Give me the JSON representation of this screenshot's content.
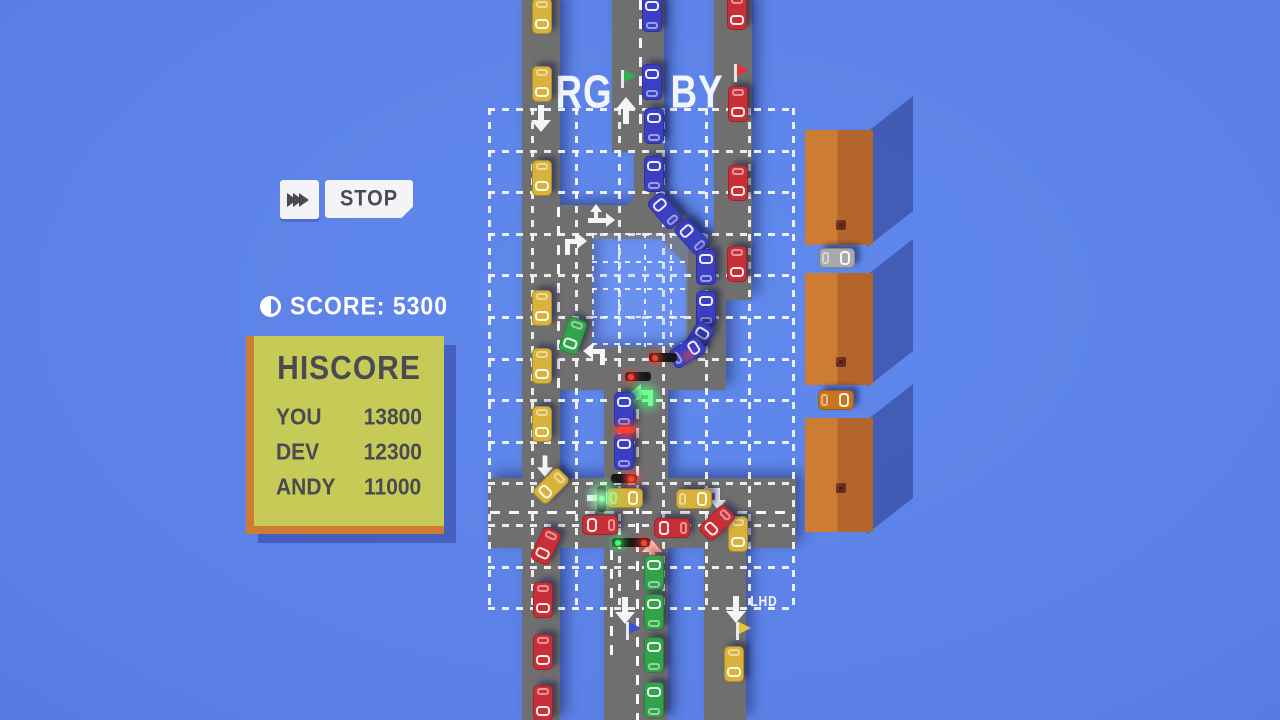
{
  "hud": {
    "stop_label": "STOP",
    "score_label": "SCORE:",
    "score_value": "5300",
    "hiscore": {
      "title": "HISCORE",
      "rows": [
        {
          "name": "YOU",
          "score": "13800"
        },
        {
          "name": "DEV",
          "score": "12300"
        },
        {
          "name": "ANDY",
          "score": "11000"
        }
      ]
    }
  },
  "palette": {
    "road": "#6F6F6F",
    "yellow": "#D8B23A",
    "blue": "#3B3FC4",
    "red": "#C92F36",
    "green": "#31A44A",
    "gray": "#A7A9AC",
    "orange": "#C8741F",
    "panel": "#C6CB57",
    "panel_edge": "#CE7B33",
    "hud_text": "#4A4A52"
  },
  "scene": {
    "labels": [
      {
        "t": "RG",
        "x": 584,
        "y": 93,
        "s": 40
      },
      {
        "t": "BY",
        "x": 697,
        "y": 93,
        "s": 40
      },
      {
        "t": "LHD",
        "x": 764,
        "y": 601,
        "s": 13
      }
    ],
    "grid": {
      "x": 488,
      "y": 108,
      "w": 304,
      "h": 502,
      "nx": 8,
      "sx": 43.4,
      "ny": 13,
      "sy": 41.6
    },
    "block": {
      "x": 592,
      "y": 233,
      "w": 96,
      "h": 114,
      "nx": 4,
      "sx": 26,
      "ny": 5,
      "sy": 27.5
    },
    "roads": [
      {
        "x": 522,
        "y": 0,
        "w": 38,
        "h": 720
      },
      {
        "x": 612,
        "y": 0,
        "w": 52,
        "h": 152
      },
      {
        "x": 634,
        "y": 150,
        "w": 30,
        "h": 60
      },
      {
        "x": 556,
        "y": 205,
        "w": 118,
        "h": 34
      },
      {
        "x": 655,
        "y": 180,
        "w": 34,
        "h": 94,
        "rot": -45
      },
      {
        "x": 714,
        "y": 0,
        "w": 38,
        "h": 300
      },
      {
        "x": 686,
        "y": 240,
        "w": 64,
        "h": 60
      },
      {
        "x": 686,
        "y": 235,
        "w": 40,
        "h": 155
      },
      {
        "x": 556,
        "y": 205,
        "w": 36,
        "h": 185
      },
      {
        "x": 522,
        "y": 347,
        "w": 204,
        "h": 43
      },
      {
        "x": 604,
        "y": 347,
        "w": 64,
        "h": 373
      },
      {
        "x": 488,
        "y": 478,
        "w": 308,
        "h": 70
      },
      {
        "x": 704,
        "y": 478,
        "w": 42,
        "h": 242
      }
    ],
    "lanes": [
      {
        "x": 639,
        "y": 0,
        "len": 150,
        "v": true
      },
      {
        "x": 636,
        "y": 390,
        "len": 330,
        "v": true
      },
      {
        "x": 557,
        "y": 207,
        "len": 181,
        "v": true
      },
      {
        "x": 610,
        "y": 550,
        "len": 110,
        "v": true
      },
      {
        "x": 490,
        "y": 511,
        "len": 304,
        "v": false
      }
    ],
    "arrows": [
      {
        "x": 541,
        "y": 117,
        "rot": 180,
        "t": "str"
      },
      {
        "x": 626,
        "y": 112,
        "rot": 0,
        "t": "str"
      },
      {
        "x": 599,
        "y": 220,
        "rot": 0,
        "t": "fork"
      },
      {
        "x": 574,
        "y": 246,
        "rot": 0,
        "t": "upRight"
      },
      {
        "x": 596,
        "y": 356,
        "rot": 0,
        "t": "upLeft"
      },
      {
        "x": 545,
        "y": 465,
        "rot": 180,
        "t": "str",
        "scale": 0.8
      },
      {
        "x": 599,
        "y": 498,
        "rot": 90,
        "t": "str"
      },
      {
        "x": 713,
        "y": 497,
        "rot": 90,
        "t": "upRight"
      },
      {
        "x": 652,
        "y": 555,
        "rot": 0,
        "t": "str"
      },
      {
        "x": 625,
        "y": 609,
        "rot": 180,
        "t": "str"
      },
      {
        "x": 736,
        "y": 608,
        "rot": 180,
        "t": "str"
      },
      {
        "x": 644,
        "y": 397,
        "rot": 0,
        "t": "upLeft",
        "c": "#8CFFA8",
        "glow": true,
        "active": true
      }
    ],
    "buildings": [
      {
        "x": 805,
        "y": 130,
        "w": 68,
        "h": 115,
        "cy": 0.78
      },
      {
        "x": 805,
        "y": 273,
        "w": 68,
        "h": 112,
        "cy": 0.75
      },
      {
        "x": 805,
        "y": 418,
        "w": 68,
        "h": 114,
        "cy": 0.57
      }
    ],
    "cars": [
      {
        "x": 542,
        "y": 16,
        "r": 180,
        "c": "yellow"
      },
      {
        "x": 542,
        "y": 84,
        "r": 180,
        "c": "yellow"
      },
      {
        "x": 542,
        "y": 178,
        "r": 180,
        "c": "yellow"
      },
      {
        "x": 542,
        "y": 308,
        "r": 180,
        "c": "yellow"
      },
      {
        "x": 542,
        "y": 366,
        "r": 180,
        "c": "yellow"
      },
      {
        "x": 542,
        "y": 424,
        "r": 180,
        "c": "yellow"
      },
      {
        "x": 551,
        "y": 486,
        "r": 225,
        "c": "yellow"
      },
      {
        "x": 625,
        "y": 498,
        "r": 90,
        "c": "yellow"
      },
      {
        "x": 694,
        "y": 499,
        "r": 90,
        "c": "yellow"
      },
      {
        "x": 738,
        "y": 534,
        "r": 180,
        "c": "yellow"
      },
      {
        "x": 734,
        "y": 664,
        "r": 180,
        "c": "yellow"
      },
      {
        "x": 652,
        "y": 14,
        "r": 0,
        "c": "blue"
      },
      {
        "x": 652,
        "y": 82,
        "r": 0,
        "c": "blue"
      },
      {
        "x": 654,
        "y": 126,
        "r": 0,
        "c": "blue"
      },
      {
        "x": 654,
        "y": 174,
        "r": 0,
        "c": "blue"
      },
      {
        "x": 665,
        "y": 211,
        "r": -40,
        "c": "blue"
      },
      {
        "x": 692,
        "y": 237,
        "r": -42,
        "c": "blue"
      },
      {
        "x": 706,
        "y": 267,
        "r": 0,
        "c": "blue"
      },
      {
        "x": 706,
        "y": 309,
        "r": 0,
        "c": "blue"
      },
      {
        "x": 698,
        "y": 340,
        "r": 32,
        "c": "blue"
      },
      {
        "x": 687,
        "y": 352,
        "r": 58,
        "c": "blue"
      },
      {
        "x": 624,
        "y": 410,
        "r": 0,
        "c": "blue"
      },
      {
        "x": 624,
        "y": 452,
        "r": 0,
        "c": "blue"
      },
      {
        "x": 737,
        "y": 12,
        "r": 180,
        "c": "red"
      },
      {
        "x": 738,
        "y": 104,
        "r": 180,
        "c": "red"
      },
      {
        "x": 738,
        "y": 183,
        "r": 180,
        "c": "red"
      },
      {
        "x": 737,
        "y": 264,
        "r": 180,
        "c": "red"
      },
      {
        "x": 600,
        "y": 525,
        "r": -90,
        "c": "red"
      },
      {
        "x": 672,
        "y": 528,
        "r": -90,
        "c": "red"
      },
      {
        "x": 717,
        "y": 523,
        "r": 225,
        "c": "red"
      },
      {
        "x": 546,
        "y": 546,
        "r": 205,
        "c": "red"
      },
      {
        "x": 543,
        "y": 600,
        "r": 180,
        "c": "red"
      },
      {
        "x": 543,
        "y": 652,
        "r": 180,
        "c": "red"
      },
      {
        "x": 543,
        "y": 703,
        "r": 180,
        "c": "red"
      },
      {
        "x": 573,
        "y": 336,
        "r": 200,
        "c": "green"
      },
      {
        "x": 654,
        "y": 573,
        "r": 0,
        "c": "green"
      },
      {
        "x": 654,
        "y": 612,
        "r": 0,
        "c": "green"
      },
      {
        "x": 654,
        "y": 655,
        "r": 0,
        "c": "green"
      },
      {
        "x": 654,
        "y": 700,
        "r": 0,
        "c": "green"
      },
      {
        "x": 837,
        "y": 258,
        "r": 90,
        "c": "gray"
      },
      {
        "x": 836,
        "y": 400,
        "r": 90,
        "c": "orange"
      }
    ],
    "lights": [
      {
        "x": 611,
        "y": 474,
        "w": 26,
        "h": 9,
        "dots": [
          {
            "c": "red",
            "p": "right"
          }
        ]
      },
      {
        "x": 597,
        "y": 486,
        "w": 9,
        "h": 26,
        "dots": [
          {
            "c": "green",
            "p": "center"
          }
        ]
      },
      {
        "x": 612,
        "y": 538,
        "w": 38,
        "h": 9,
        "dots": [
          {
            "c": "green",
            "p": "left"
          },
          {
            "c": "red",
            "p": "right"
          }
        ]
      },
      {
        "x": 625,
        "y": 372,
        "w": 26,
        "h": 9,
        "dots": [
          {
            "c": "red",
            "p": "left"
          }
        ]
      },
      {
        "x": 649,
        "y": 353,
        "w": 28,
        "h": 9,
        "dots": [
          {
            "c": "red",
            "p": "left"
          }
        ]
      },
      {
        "x": 617,
        "y": 427,
        "w": 17,
        "h": 6,
        "solid": true
      }
    ],
    "glows": [
      {
        "x": 604,
        "y": 497,
        "r": 30,
        "c": "green"
      },
      {
        "x": 646,
        "y": 398,
        "r": 26,
        "c": "green"
      },
      {
        "x": 633,
        "y": 478,
        "r": 15,
        "c": "red"
      },
      {
        "x": 626,
        "y": 431,
        "r": 13,
        "c": "red"
      },
      {
        "x": 654,
        "y": 549,
        "r": 15,
        "c": "red"
      },
      {
        "x": 688,
        "y": 356,
        "r": 12,
        "c": "red"
      },
      {
        "x": 600,
        "y": 498,
        "r": 22,
        "c": "white"
      }
    ],
    "flags": [
      {
        "x": 621,
        "y": 70,
        "c": "#2FB24A"
      },
      {
        "x": 734,
        "y": 64,
        "c": "#E23434"
      },
      {
        "x": 626,
        "y": 622,
        "c": "#3B4FD8"
      },
      {
        "x": 736,
        "y": 622,
        "c": "#E8C43C"
      }
    ]
  }
}
